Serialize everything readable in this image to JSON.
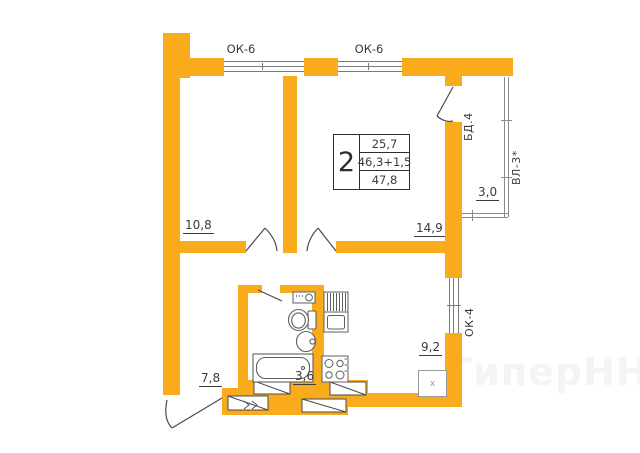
{
  "colors": {
    "wall": "#FAAB1C",
    "line": "#4a4a4a",
    "thin": "#8a8a8a",
    "text": "#3b3b3b",
    "watermark": "#f4f4f4"
  },
  "spec_table": {
    "room_count": "2",
    "living_area": "25,7",
    "area_sum": "46,3+1,5",
    "total_area": "47,8"
  },
  "areas": {
    "room1": "10,8",
    "living_room": "14,9",
    "hallway": "7,8",
    "bathroom": "3,6",
    "kitchen": "9,2",
    "balcony": "3,0"
  },
  "openings": {
    "window_top_left": "ОК-6",
    "window_top_right": "ОК-6",
    "balcony_door": "БД.4",
    "balcony_glazing": "ВЛ-3*",
    "kitchen_window": "ОК-4"
  },
  "fixtures": {
    "appliance_mark": "x"
  },
  "watermark": {
    "text": "ГиперНН"
  }
}
